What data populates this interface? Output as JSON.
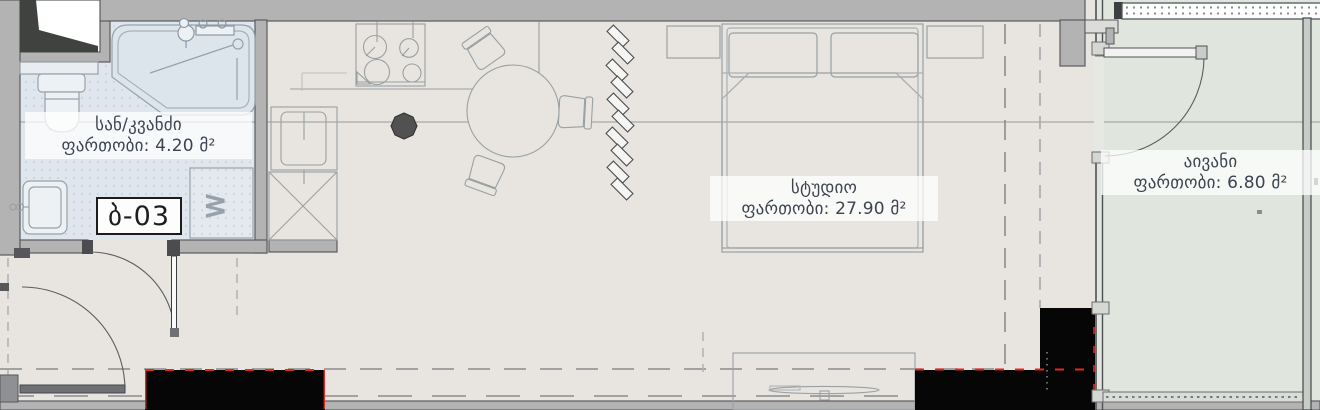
{
  "plan": {
    "unit_number": "ბ-03",
    "washer_label": "W",
    "rooms": [
      {
        "id": "bathroom",
        "name": "სან/კვანძი",
        "area_label": "ფართობი: 4.20 მ²"
      },
      {
        "id": "studio",
        "name": "სტუდიო",
        "area_label": "ფართობი: 27.90 მ²"
      },
      {
        "id": "balcony",
        "name": "აივანი",
        "area_label": "ფართობი: 6.80 მ²"
      }
    ],
    "colors": {
      "wall": "#b3b3b3",
      "wall_edge": "#55575b",
      "floor": "#e8e5e1",
      "bathroom_floor": "#dfe6ed",
      "balcony_floor": "#e0e5dd",
      "label_text": "#3d4450",
      "redacted_block": "#060606",
      "boundary_red": "#e0281e"
    }
  }
}
